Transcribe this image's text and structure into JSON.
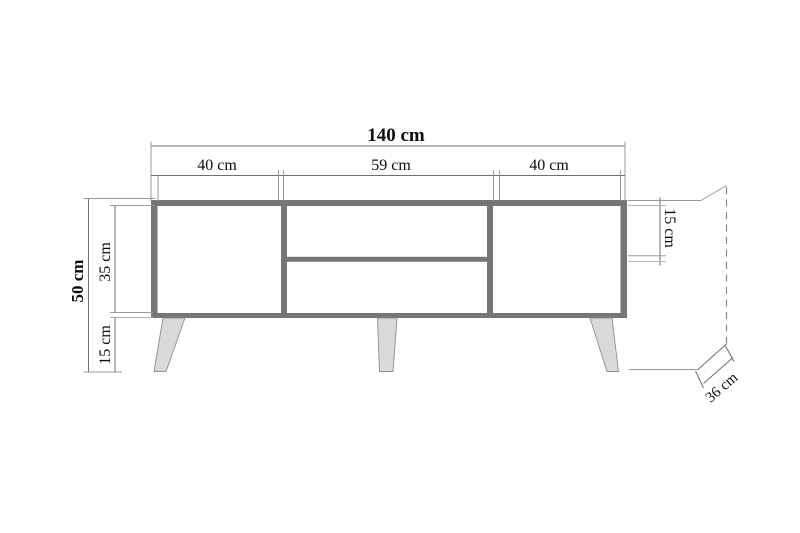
{
  "diagram": {
    "kind": "furniture-dimension-drawing",
    "subject": "tv-stand-front-elevation",
    "unit": "cm"
  },
  "dimensions": {
    "total_width": {
      "label": "140 cm",
      "value": 140
    },
    "top_sections": [
      {
        "label": "40 cm",
        "value": 40
      },
      {
        "label": "59 cm",
        "value": 59
      },
      {
        "label": "40 cm",
        "value": 40
      }
    ],
    "total_height": {
      "label": "50 cm",
      "value": 50
    },
    "body_height": {
      "label": "35 cm",
      "value": 35
    },
    "leg_height": {
      "label": "15 cm",
      "value": 15
    },
    "top_opening_height": {
      "label": "15 cm",
      "value": 15
    },
    "depth": {
      "label": "36 cm",
      "value": 36
    }
  },
  "colors": {
    "frame_gray": "#767676",
    "opening_white": "#ffffff",
    "leg_fill": "#d9d9d9",
    "leg_stroke": "#8f8f8f",
    "dim_line": "#6e6e6e",
    "text": "#0d0d0d",
    "background": "#ffffff"
  }
}
